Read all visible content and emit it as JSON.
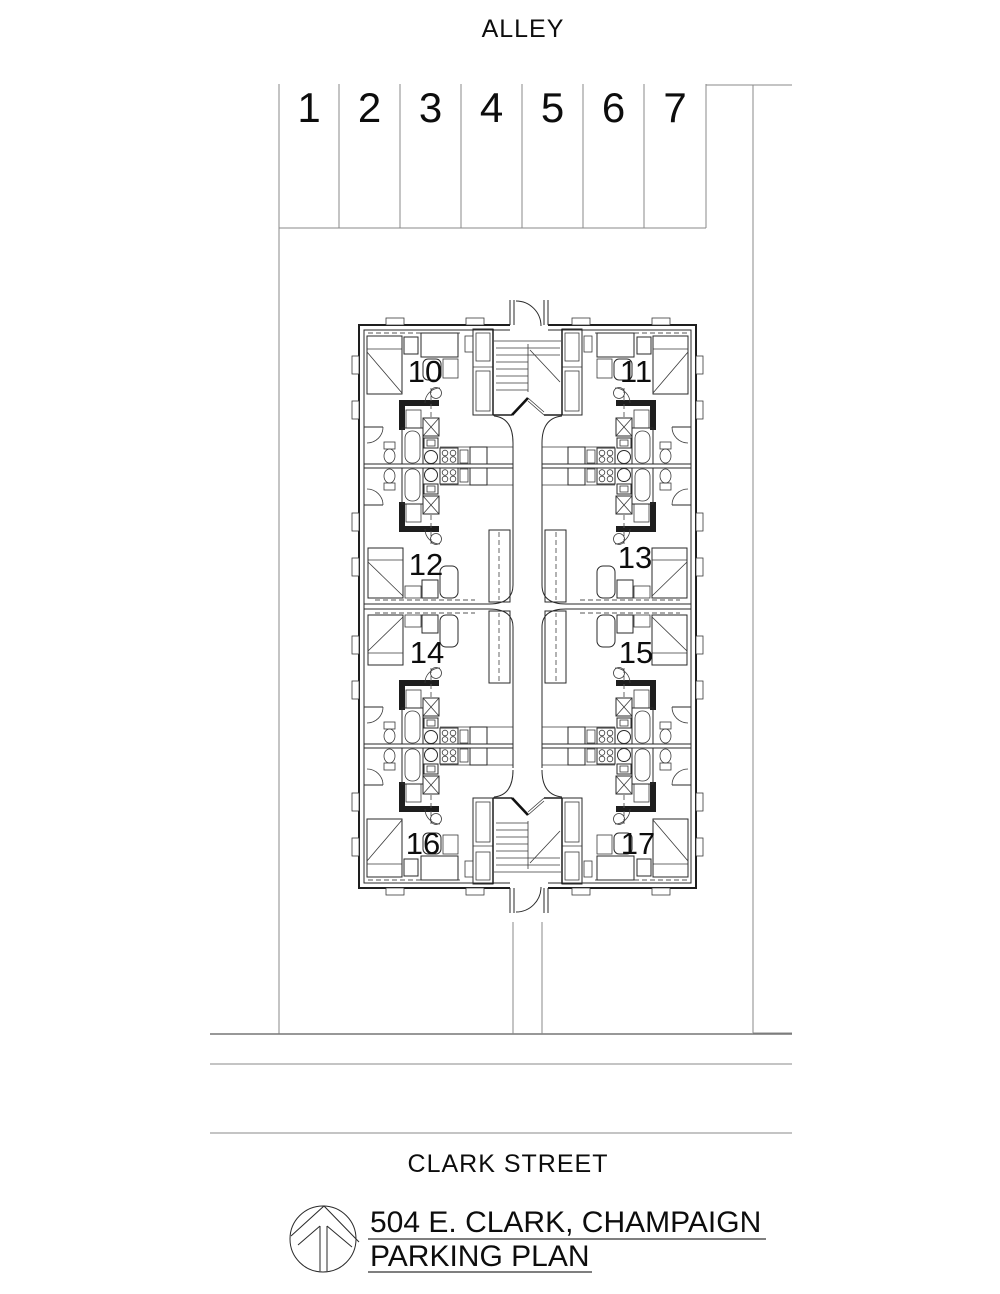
{
  "plan": {
    "alley_label": "ALLEY",
    "street_label": "CLARK STREET",
    "stalls": [
      "1",
      "2",
      "3",
      "4",
      "5",
      "6",
      "7"
    ],
    "units": [
      "10",
      "11",
      "12",
      "13",
      "14",
      "15",
      "16",
      "17"
    ],
    "title": {
      "line1": "504 E. CLARK, CHAMPAIGN",
      "line2": "PARKING PLAN"
    },
    "logo_icon": "north-arrow-circle-logo",
    "colors": {
      "paper": "#ffffff",
      "site_line": "#8a8a8a",
      "wall_line": "#1e1e1e",
      "text": "#0d0d0d"
    }
  }
}
